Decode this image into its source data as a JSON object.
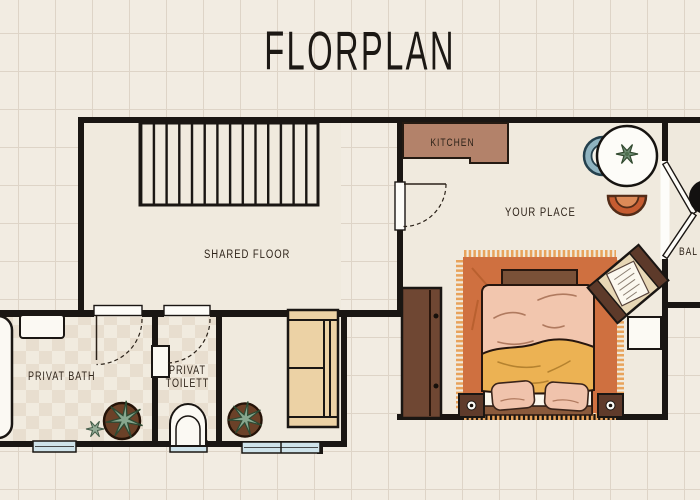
{
  "title": "FLORPLAN",
  "rooms": {
    "kitchen": {
      "label": "KITCHEN"
    },
    "your_place": {
      "label": "YOUR PLACE"
    },
    "shared_floor": {
      "label": "SHARED FLOOR"
    },
    "privat_bath": {
      "label": "PRIVAT BATH"
    },
    "privat_toilett": {
      "line1": "PRIVAT",
      "line2": "TOILETT"
    },
    "balcony": {
      "label": "BAL"
    }
  },
  "furniture_icons": [
    "staircase",
    "kitchen-counter",
    "dining-table",
    "table-plant-icon",
    "chair-blue",
    "chair-orange",
    "balcony-french-doors",
    "balcony-table",
    "desk",
    "side-table",
    "wardrobe",
    "double-bed",
    "rug",
    "pillow",
    "nightstand",
    "sofa",
    "bathtub",
    "sink",
    "toilet",
    "potted-plant-icon",
    "snowflake-plant-icon",
    "window",
    "door-swing"
  ],
  "colors": {
    "background": "#f2ece2",
    "grid_line": "#ded4c7",
    "wall": "#1a1613",
    "room_floor": "#f0eade",
    "checker_tile": "#e8decf",
    "kitchen_counter": "#b3826a",
    "rug_orange": "#cf7040",
    "rug_fringe": "#e8a35b",
    "duvet_pink": "#f2c6ae",
    "blanket_yellow": "#ecb253",
    "pillow_pink": "#f0c3ac",
    "wood_dark": "#5f3b2b",
    "wood_mid": "#7a5138",
    "wardrobe_brown": "#6f4733",
    "sofa_tan": "#ecd2a5",
    "window_blue": "#cfe3ea",
    "chair_blue": "#8fb3c0",
    "chair_orange": "#c65c31",
    "plant_green": "#87a78f",
    "pot_brown": "#6b4128",
    "text": "#2e2319"
  }
}
